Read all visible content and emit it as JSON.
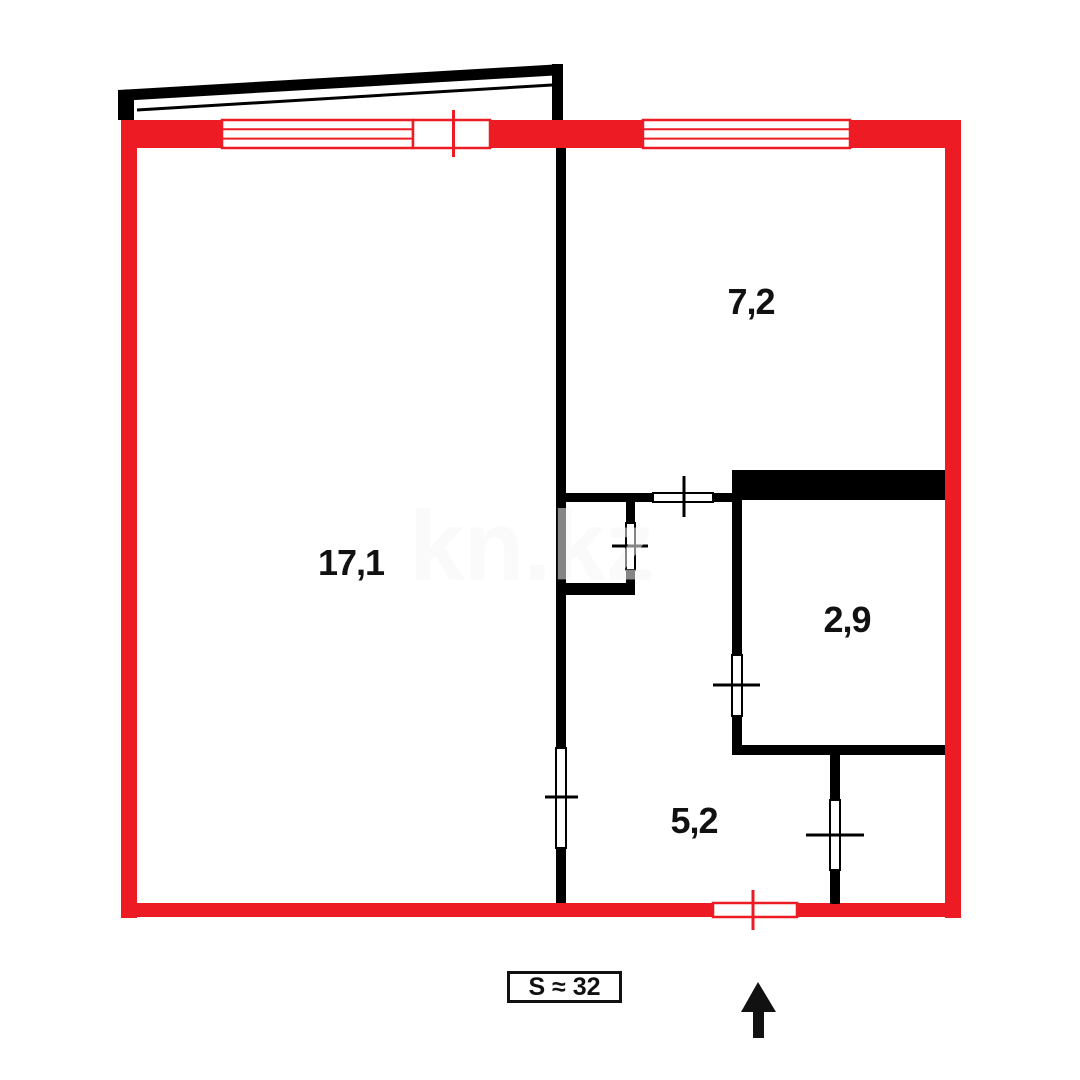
{
  "floorplan": {
    "watermark": "kn.kz",
    "total_area_label": "S ≈ 32",
    "rooms": [
      {
        "area": "17,1"
      },
      {
        "area": "7,2"
      },
      {
        "area": "2,9"
      },
      {
        "area": "5,2"
      }
    ],
    "colors": {
      "outer_wall_red": "#ed1c24",
      "inner_wall_black": "#000000",
      "background": "#ffffff",
      "watermark_tint": "rgba(255,255,255,0.52)"
    },
    "compass": {
      "icon": "north-arrow",
      "points": "up"
    }
  }
}
